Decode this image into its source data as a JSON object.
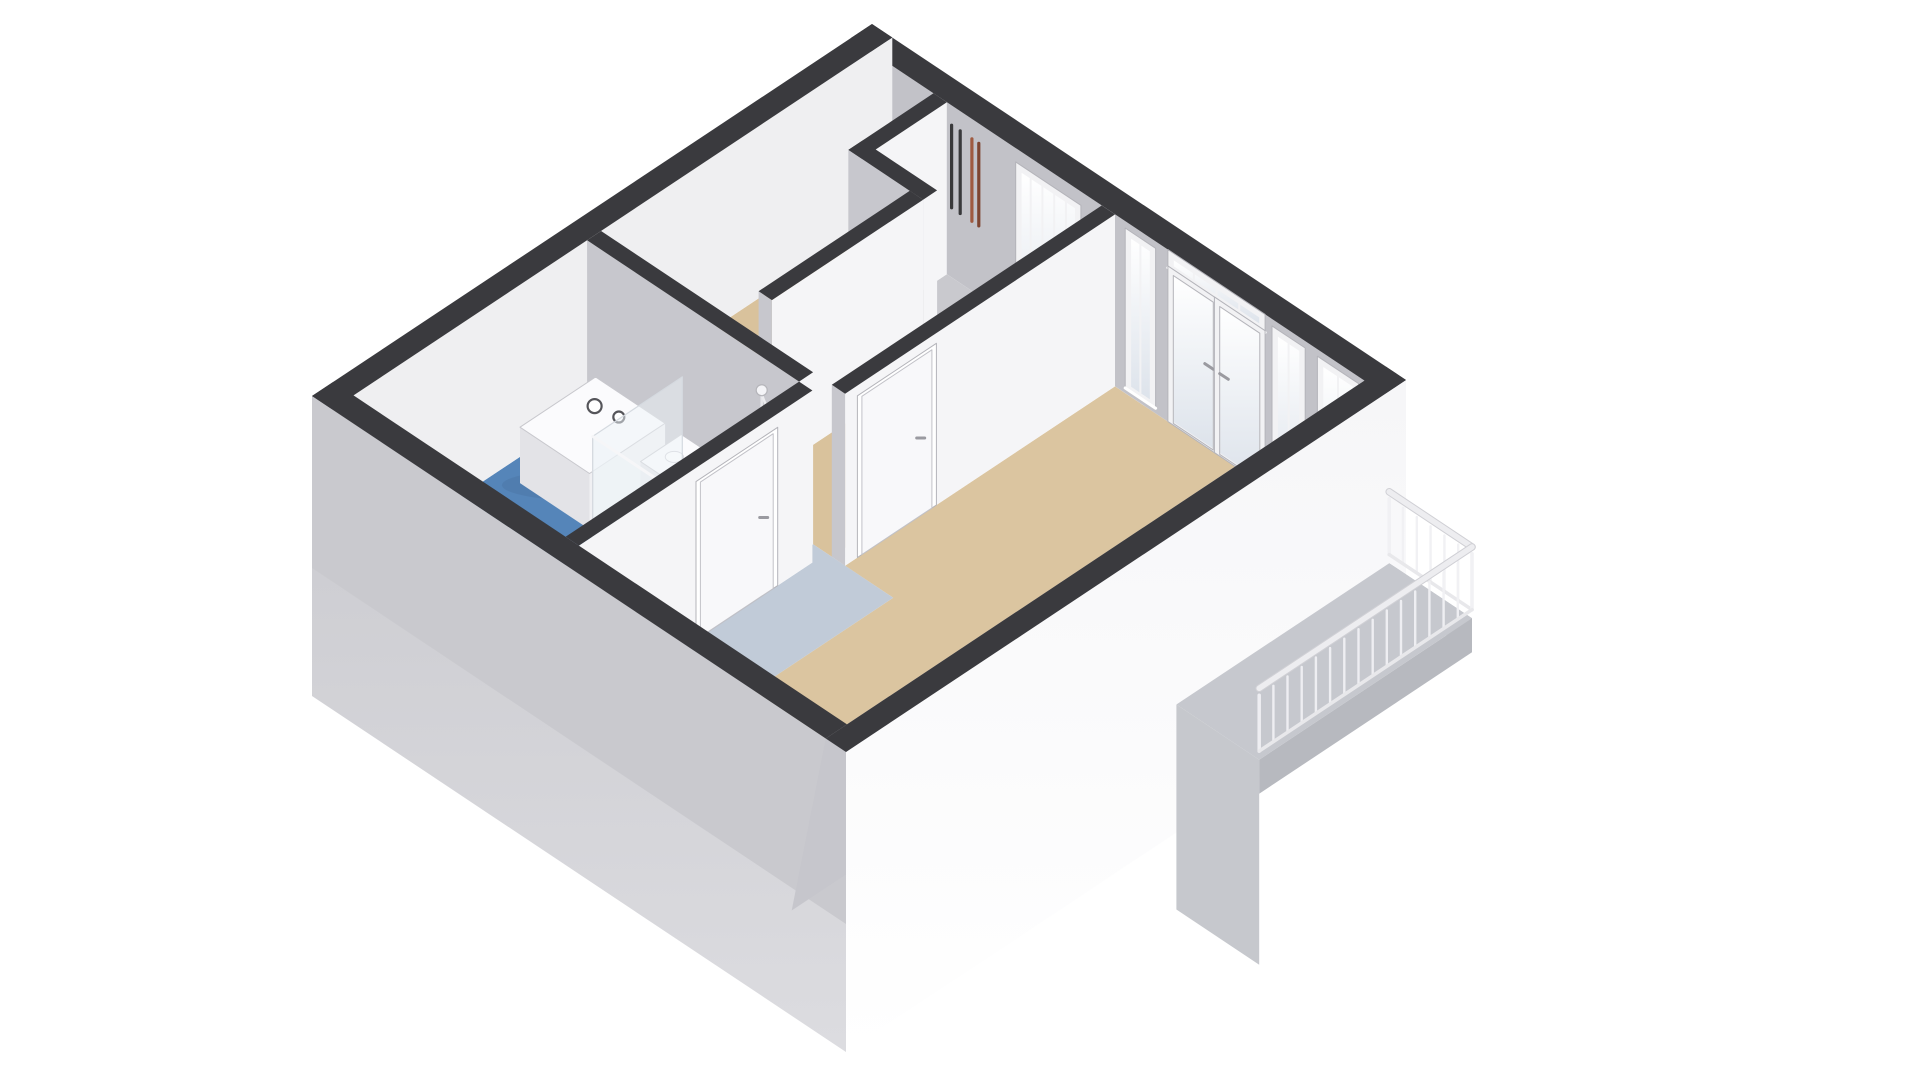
{
  "scene": {
    "title": "3D floor plan of a studio apartment, axonometric top-down view",
    "background": "#ffffff"
  },
  "projection": {
    "origin": [
      872,
      24
    ],
    "u_axis": [
      534,
      356
    ],
    "v_axis": [
      -560,
      372
    ],
    "wall_height_px": 172,
    "facade_depth_px": 300,
    "se_inner_shear_px": -34
  },
  "colors": {
    "wall_band": "#3a3a3e",
    "face_se": "#f5f5f7",
    "face_sw": "#c7c7cd",
    "ne_inner": "#c2c2c8",
    "nw_inner": "#efeff1",
    "se_inner": "#c6c6cc",
    "facade_se": "#f6f6f8",
    "facade_sw": "#c9c9ce",
    "floor_living": "#dbc5a0",
    "floor_hall": "#d9c29c",
    "floor_kitchen": "#c1cbd8",
    "floor_bath": "#5585b9",
    "floor_shower": "#4373a6",
    "floor_bath_pale": "#a0b4ca",
    "floor_shaft": "#c9c9ce",
    "frame": "#f2f2f4",
    "frame_stroke": "#b4b4ba",
    "glass_top": "#ffffff",
    "glass_bottom": "#dde3eb",
    "door_leaf": "#f8f8fa",
    "door_stroke": "#c2c2c8",
    "handle": "#9a9aa0",
    "balcony_floor": "#c6c8ce",
    "balcony_skirt": "#b7b9bf",
    "balcony_shadow": "#c6c8cd",
    "railing": "#f1f1f4",
    "railing_rail": "#ededf0",
    "railing_stroke": "#d0d0d5",
    "pipe_dark": "#39393b",
    "pipe_copper_a": "#9f5a40",
    "pipe_copper_b": "#7e4531",
    "fixture_white": "#fbfbfd",
    "fixture_face": "#f0f0f3",
    "fixture_side": "#e3e3e7",
    "fixture_stroke": "#c8c8cd",
    "glass_panel": "rgba(238,243,248,0.5)",
    "glass_panel_stroke": "#d5dae0",
    "shadow": "rgba(30,40,60,0.08)"
  },
  "walls_far": [
    {
      "name": "wall-ne-exterior",
      "rect": [
        0,
        0,
        1,
        0.038
      ],
      "face_sw": "ne_inner"
    },
    {
      "name": "wall-nw-exterior",
      "rect": [
        0,
        0,
        0.038,
        1
      ],
      "face_se": "nw_inner"
    }
  ],
  "walls_interior": [
    {
      "name": "wall-shaft-left",
      "rect": [
        0.155,
        0.038,
        0.18,
        0.19
      ]
    },
    {
      "name": "wall-shaft-sw",
      "rect": [
        0.155,
        0.165,
        0.295,
        0.19
      ]
    },
    {
      "name": "wall-corridor-nw",
      "rect": [
        0.27,
        0.19,
        0.295,
        0.46
      ]
    },
    {
      "name": "wall-corridor-se",
      "rect": [
        0.47,
        0.038,
        0.495,
        0.52
      ]
    },
    {
      "name": "wall-bathroom-ne",
      "rect": [
        0.038,
        0.52,
        0.435,
        0.545
      ]
    }
  ],
  "wall_bath_se": {
    "name": "wall-bathroom-se",
    "rect": [
      0.435,
      0.545,
      0.46,
      0.962
    ]
  },
  "walls_near": [
    {
      "name": "wall-sw-exterior",
      "rect": [
        0,
        0.962,
        1,
        1
      ]
    },
    {
      "name": "wall-se-exterior",
      "rect": [
        0.962,
        0,
        1,
        1
      ]
    }
  ],
  "floors": [
    {
      "name": "floor-shaft",
      "color": "floor_shaft",
      "poly": [
        [
          0.18,
          0.038
        ],
        [
          0.27,
          0.038
        ],
        [
          0.27,
          0.165
        ],
        [
          0.18,
          0.165
        ]
      ]
    },
    {
      "name": "floor-hall",
      "color": "floor_hall",
      "poly": [
        [
          0.038,
          0.038
        ],
        [
          0.155,
          0.038
        ],
        [
          0.155,
          0.19
        ],
        [
          0.27,
          0.19
        ],
        [
          0.27,
          0.52
        ],
        [
          0.038,
          0.52
        ]
      ]
    },
    {
      "name": "floor-entry-corridor",
      "color": "floor_hall",
      "poly": [
        [
          0.295,
          0.038
        ],
        [
          0.47,
          0.038
        ],
        [
          0.47,
          0.52
        ],
        [
          0.295,
          0.52
        ]
      ]
    },
    {
      "name": "floor-living-room",
      "color": "floor_living",
      "poly": [
        [
          0.495,
          0.038
        ],
        [
          0.962,
          0.038
        ],
        [
          0.962,
          0.8
        ],
        [
          0.585,
          0.8
        ],
        [
          0.585,
          0.52
        ],
        [
          0.495,
          0.52
        ]
      ]
    },
    {
      "name": "floor-kitchen-strip",
      "color": "floor_kitchen",
      "poly": [
        [
          0.435,
          0.52
        ],
        [
          0.585,
          0.52
        ],
        [
          0.585,
          0.8
        ],
        [
          0.962,
          0.8
        ],
        [
          0.962,
          0.962
        ],
        [
          0.46,
          0.962
        ],
        [
          0.46,
          0.545
        ],
        [
          0.435,
          0.545
        ]
      ]
    },
    {
      "name": "floor-bathroom",
      "color": "floor_bath",
      "poly": [
        [
          0.038,
          0.545
        ],
        [
          0.435,
          0.545
        ],
        [
          0.435,
          0.962
        ],
        [
          0.038,
          0.962
        ]
      ]
    },
    {
      "name": "floor-shower",
      "color": "floor_shower",
      "poly": [
        [
          0.295,
          0.545
        ],
        [
          0.435,
          0.545
        ],
        [
          0.435,
          0.78
        ],
        [
          0.295,
          0.78
        ]
      ]
    },
    {
      "name": "floor-bathroom-pale",
      "color": "floor_bath_pale",
      "poly": [
        [
          0.038,
          0.9
        ],
        [
          0.295,
          0.9
        ],
        [
          0.295,
          0.962
        ],
        [
          0.038,
          0.962
        ]
      ]
    }
  ],
  "pipes": {
    "v": 0.06,
    "h_top": 0.02,
    "h_bottom": 0.5,
    "width": 3.2,
    "dark_u": [
      0.196,
      0.212,
      0.228
    ],
    "copper_u": [
      0.25,
      0.263
    ]
  },
  "ne_openings": [
    {
      "name": "front-door",
      "type": "glazed_door",
      "u0": 0.315,
      "u1": 0.425,
      "h0": 0.1,
      "h1": 1.0,
      "bars": 4
    },
    {
      "name": "window-left",
      "type": "window",
      "u0": 0.52,
      "u1": 0.565,
      "h0": 0.06,
      "h1": 0.97,
      "bars": 1
    },
    {
      "name": "french-door-transom",
      "type": "window",
      "u0": 0.6,
      "u1": 0.77,
      "h0": 0.02,
      "h1": 0.105,
      "bars": 3
    },
    {
      "name": "french-door-left",
      "type": "door_glass",
      "u0": 0.6,
      "u1": 0.683,
      "h0": 0.115,
      "h1": 1.0
    },
    {
      "name": "french-door-right",
      "type": "door_glass",
      "u0": 0.687,
      "u1": 0.77,
      "h0": 0.115,
      "h1": 1.0
    },
    {
      "name": "window-mid",
      "type": "window",
      "u0": 0.795,
      "u1": 0.845,
      "h0": 0.06,
      "h1": 0.97,
      "bars": 1
    },
    {
      "name": "window-right",
      "type": "window",
      "u0": 0.88,
      "u1": 0.945,
      "h0": 0.06,
      "h1": 0.97,
      "bars": 1
    }
  ],
  "se_window": {
    "name": "window-se-wall",
    "v0": 0.17,
    "v1": 0.31,
    "h0": 0.1,
    "h1": 0.82,
    "bars": 4
  },
  "interior_doors": [
    {
      "name": "door-hall-to-living",
      "wall_u": 0.495,
      "v0": 0.365,
      "v1": 0.49,
      "h0": 0.08,
      "h1": 1.0,
      "handle_v": 0.385
    },
    {
      "name": "door-bathroom",
      "wall_u": 0.46,
      "v0": 0.615,
      "v1": 0.745,
      "h0": 0.1,
      "h1": 1.0,
      "handle_v": 0.632
    }
  ],
  "fixtures": {
    "washing_machine": {
      "name": "washing-machine",
      "rect": [
        0.075,
        0.565,
        0.205,
        0.7
      ],
      "top_h": 0.675,
      "knobs": [
        {
          "u": 0.115,
          "v": 0.605,
          "r": 7
        },
        {
          "u": 0.153,
          "v": 0.598,
          "r": 5.5
        }
      ]
    },
    "sink": {
      "name": "sink",
      "rect": [
        0.225,
        0.555,
        0.275,
        0.628
      ],
      "top_h": 0.72
    },
    "shower": {
      "name": "shower",
      "glass_u0": 0.295,
      "glass_u1": 0.435,
      "glass_v": 0.78,
      "return_v0": 0.62,
      "return_v1": 0.78,
      "return_u": 0.295,
      "head_u": 0.365,
      "head_wall_v": 0.545
    },
    "toilet": {
      "name": "toilet",
      "bowl_u": 0.375,
      "bowl_v": 0.862,
      "tank_rect": [
        0.398,
        0.82,
        0.432,
        0.9
      ],
      "tank_top_h": 0.58
    }
  },
  "balcony": {
    "name": "balcony",
    "u0": 1.0,
    "u1": 1.155,
    "v0": 0.03,
    "v1": 0.41,
    "skirt_px": 34,
    "shadow_px": 205,
    "rail_top_h": 0.585,
    "rail_bottom_h": 0.95,
    "balusters_ne_edge": 7,
    "balusters_far_edge": 16
  }
}
